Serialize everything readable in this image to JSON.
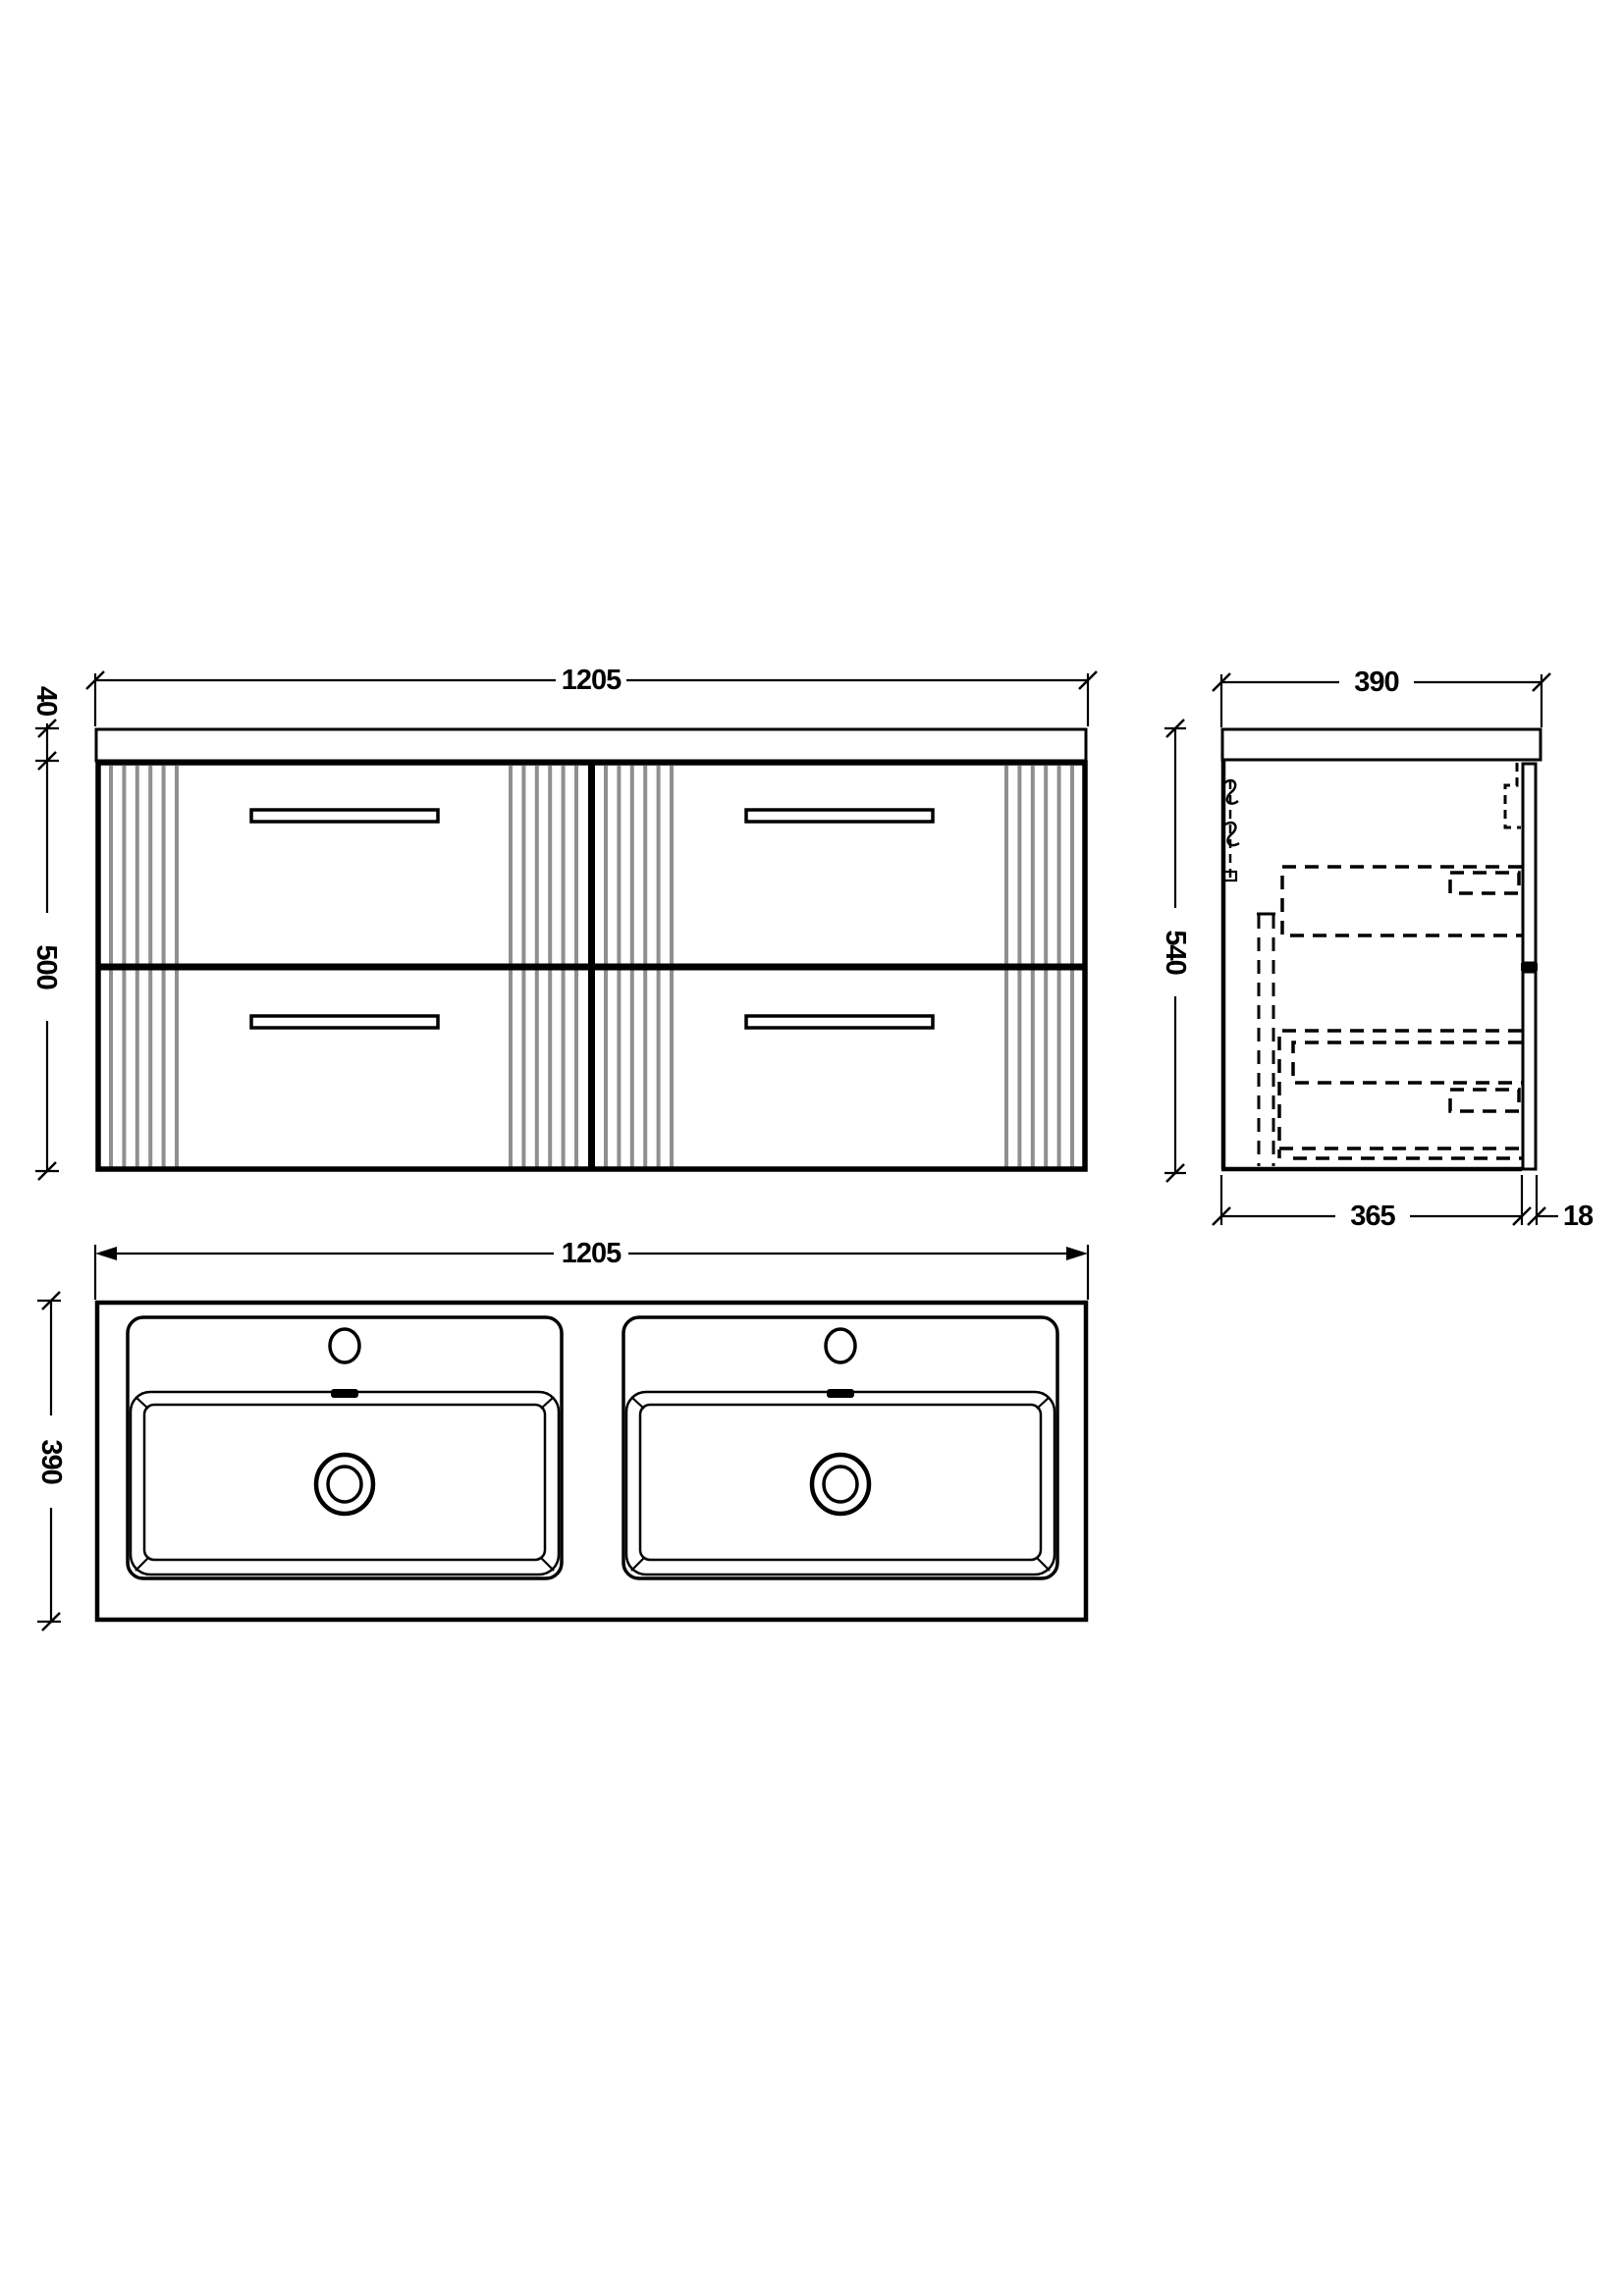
{
  "views": {
    "front": {
      "dims": {
        "width": "1205",
        "counter_thickness": "40",
        "cabinet_height": "500"
      }
    },
    "side": {
      "dims": {
        "depth": "390",
        "overall_height": "540",
        "carcass_depth": "365",
        "front_thickness": "18"
      }
    },
    "plan": {
      "dims": {
        "width": "1205",
        "depth": "390"
      }
    }
  },
  "colors": {
    "line": "#000000",
    "flute": "#8f8f8f",
    "bg": "#ffffff"
  }
}
